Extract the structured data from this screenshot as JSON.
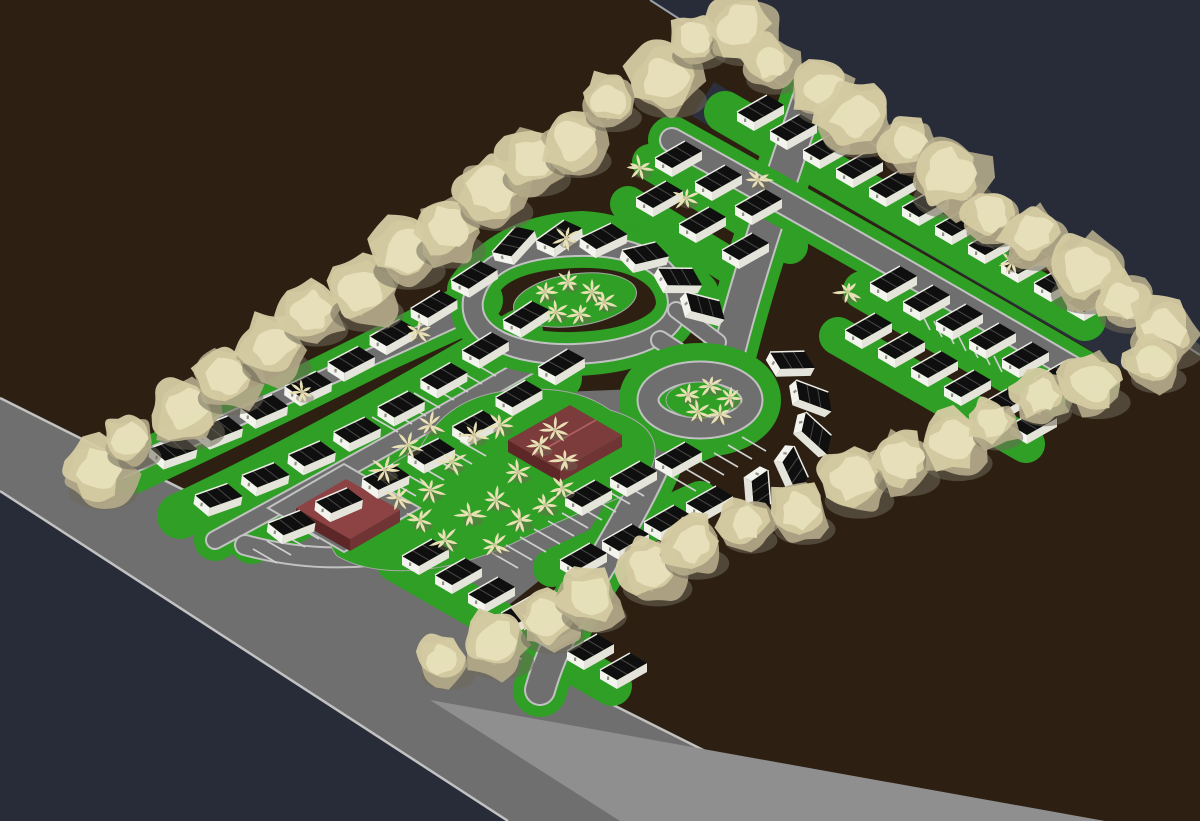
{
  "scene": {
    "title": "isometric-residential-site-plan-render",
    "canvas": {
      "width": 1200,
      "height": 821
    },
    "colors": {
      "background_navy": "#272c38",
      "ground_brown": "#2d2013",
      "edge_hairline": "#9aa0a8",
      "road_gray": "#6f6f6f",
      "road_shoulder": "#8f8f8f",
      "curb_light": "#c2c2c2",
      "stripe_white": "#d0d0d0",
      "lawn_green": "#2f9f25",
      "house_wall": "#f4f4ee",
      "house_wall_shade": "#e4e4da",
      "roof_black": "#0f0f0f",
      "roof_seam": "#474747",
      "roof_ridge": "#ededE6",
      "door_dot": "#8f8f86",
      "tree_light": "#e7e0ba",
      "tree_mid": "#d5cba2",
      "tree_dark": "#b5ab8b",
      "tree_shadow": "#6e6857",
      "tree_trunk": "#d8d0ac",
      "palm_cream": "#e9e1b5",
      "dark_strip": "#2a2f3b",
      "maroon_top": "#8d4343",
      "maroon_mid": "#703434",
      "maroon_dark": "#5e2727",
      "clubhouse_roof": "#7d3c3c",
      "clubhouse_ridge": "#b06060"
    },
    "ground": {
      "brown_poly": [
        [
          0,
          0
        ],
        [
          650,
          0
        ],
        [
          1200,
          355
        ],
        [
          1200,
          821
        ],
        [
          845,
          821
        ],
        [
          0,
          398
        ]
      ],
      "edge_line": [
        [
          650,
          0
        ],
        [
          1200,
          355
        ]
      ],
      "navy_corner": [
        [
          0,
          491
        ],
        [
          260,
          821
        ],
        [
          0,
          821
        ]
      ],
      "main_road_poly": [
        [
          0,
          398
        ],
        [
          845,
          821
        ],
        [
          508,
          821
        ],
        [
          0,
          491
        ]
      ],
      "main_road_curb_top": [
        [
          0,
          398
        ],
        [
          845,
          821
        ]
      ],
      "main_road_curb_bottom": [
        [
          0,
          491
        ],
        [
          508,
          821
        ]
      ],
      "shoulder_poly": [
        [
          430,
          700
        ],
        [
          1105,
          821
        ],
        [
          620,
          821
        ]
      ],
      "pavement_poly": [
        [
          225,
          535
        ],
        [
          420,
          418
        ],
        [
          560,
          392
        ],
        [
          665,
          388
        ],
        [
          706,
          420
        ],
        [
          668,
          476
        ],
        [
          570,
          556
        ],
        [
          470,
          636
        ],
        [
          360,
          658
        ],
        [
          248,
          592
        ]
      ],
      "dark_strip_poly": [
        [
          714,
          82
        ],
        [
          1172,
          346
        ],
        [
          1138,
          378
        ],
        [
          692,
          116
        ]
      ]
    },
    "streets": [
      {
        "id": "street-a",
        "d": "M120,470 Q300,390 470,312",
        "w": 15,
        "verge": true
      },
      {
        "id": "street-b",
        "d": "M215,540 Q400,440 545,356",
        "w": 16,
        "verge": true
      },
      {
        "id": "entry-street",
        "d": "M245,545 C330,568 420,558 480,522 C540,492 590,468 636,468",
        "w": 18,
        "verge": false
      },
      {
        "id": "oval-loop",
        "d": "M473,300 C480,262 520,248 575,246 C640,244 676,268 678,302 C678,336 630,352 575,354 C515,356 468,336 473,300 Z",
        "w": 18,
        "verge": true
      },
      {
        "id": "collector-top",
        "d": "M808,100 C782,178 752,262 730,348",
        "w": 30,
        "verge": true
      },
      {
        "id": "collector-bottom",
        "d": "M670,426 C648,490 610,548 568,620 C555,648 546,668 540,690",
        "w": 28,
        "verge": true
      },
      {
        "id": "top-street",
        "d": "M672,140 C820,222 960,302 1096,382",
        "w": 22,
        "verge": true
      },
      {
        "id": "oval-culdesac-link",
        "d": "M660,340 C690,360 710,372 724,384",
        "w": 16,
        "verge": false
      },
      {
        "id": "oval-collector-link",
        "d": "M676,310 L718,342",
        "w": 14,
        "verge": false
      }
    ],
    "culdesac": {
      "cx": 700,
      "cy": 400,
      "ring_rx": 52,
      "ring_ry": 28,
      "island_rx": 34,
      "island_ry": 18
    },
    "oval_median": {
      "cx": 575,
      "cy": 300,
      "rx": 62,
      "ry": 26,
      "rot": -8
    },
    "row_lawns": [
      {
        "d": "M130,472 Q300,392 480,300",
        "w": 46
      },
      {
        "d": "M180,516 Q330,446 520,332",
        "w": 46
      },
      {
        "d": "M252,542 Q400,470 560,378",
        "w": 44
      },
      {
        "d": "M470,290 C500,248 540,236 582,234 C625,236 662,258 696,294",
        "w": 46
      },
      {
        "d": "M725,112 L1085,320",
        "w": 42
      },
      {
        "d": "M650,162 L790,246",
        "w": 36
      },
      {
        "d": "M628,204 L740,272",
        "w": 36
      },
      {
        "d": "M862,290 L1050,398",
        "w": 38
      },
      {
        "d": "M838,336 L1026,444",
        "w": 38
      },
      {
        "d": "M396,562 L612,686",
        "w": 40
      },
      {
        "d": "M552,568 L700,500",
        "w": 38
      },
      {
        "d": "M558,504 L712,438",
        "w": 36
      }
    ],
    "house_rows": [
      {
        "id": "nw-row-1",
        "start": [
          150,
          448
        ],
        "step": [
          43,
          -24
        ],
        "n": 8,
        "bow": 12,
        "rot0": 10,
        "rot1": -4
      },
      {
        "id": "nw-row-2",
        "start": [
          195,
          495
        ],
        "step": [
          44,
          -25
        ],
        "n": 8,
        "bow": 14,
        "rot0": 10,
        "rot1": -4
      },
      {
        "id": "nw-row-3",
        "start": [
          268,
          523
        ],
        "step": [
          45,
          -26
        ],
        "n": 7,
        "bow": 10,
        "rot0": 8,
        "rot1": -2
      },
      {
        "id": "top-row-1",
        "start": [
          737,
          112
        ],
        "step": [
          33,
          19
        ],
        "n": 11,
        "bow": 0,
        "rot0": 0,
        "rot1": 0
      },
      {
        "id": "top-row-2",
        "start": [
          655,
          158
        ],
        "step": [
          40,
          24
        ],
        "n": 3,
        "bow": 0,
        "rot0": 0,
        "rot1": 0
      },
      {
        "id": "top-row-3",
        "start": [
          636,
          198
        ],
        "step": [
          43,
          26
        ],
        "n": 3,
        "bow": 0,
        "rot0": 0,
        "rot1": 0
      },
      {
        "id": "right-mid-1",
        "start": [
          870,
          283
        ],
        "step": [
          33,
          19
        ],
        "n": 6,
        "bow": 0,
        "rot0": 0,
        "rot1": 0
      },
      {
        "id": "right-mid-2",
        "start": [
          845,
          330
        ],
        "step": [
          33,
          19
        ],
        "n": 6,
        "bow": 0,
        "rot0": 0,
        "rot1": 0
      },
      {
        "id": "bottom-row",
        "start": [
          402,
          556
        ],
        "step": [
          33,
          19
        ],
        "n": 7,
        "bow": 0,
        "rot0": 0,
        "rot1": 0
      },
      {
        "id": "bottom-row-2",
        "start": [
          560,
          560
        ],
        "step": [
          42,
          -19
        ],
        "n": 4,
        "bow": 0,
        "rot0": 0,
        "rot1": 0
      },
      {
        "id": "mid-right-row",
        "start": [
          565,
          497
        ],
        "step": [
          45,
          -19
        ],
        "n": 3,
        "bow": 0,
        "rot0": 0,
        "rot1": 0
      }
    ],
    "arc_houses": [
      [
        492,
        252,
        -18
      ],
      [
        536,
        240,
        -6
      ],
      [
        580,
        238,
        4
      ],
      [
        622,
        250,
        16
      ],
      [
        658,
        268,
        30
      ],
      [
        686,
        292,
        44
      ],
      [
        770,
        352,
        28
      ],
      [
        796,
        380,
        50
      ],
      [
        806,
        412,
        72
      ],
      [
        794,
        446,
        95
      ],
      [
        768,
        470,
        115
      ]
    ],
    "tree_lines": [
      {
        "id": "nw-tree-line",
        "a": [
          92,
          466
        ],
        "b": [
          700,
          46
        ],
        "n": 15,
        "r": 33
      },
      {
        "id": "ne-tree-line",
        "a": [
          732,
          30
        ],
        "b": [
          1166,
          332
        ],
        "n": 11,
        "r": 36
      },
      {
        "id": "se-tree-line",
        "a": [
          442,
          658
        ],
        "b": [
          1148,
          358
        ],
        "n": 15,
        "r": 32
      }
    ],
    "palms_island": [
      [
        385,
        470
      ],
      [
        408,
        445
      ],
      [
        430,
        490
      ],
      [
        452,
        462
      ],
      [
        474,
        435
      ],
      [
        496,
        500
      ],
      [
        518,
        472
      ],
      [
        540,
        445
      ],
      [
        562,
        488
      ],
      [
        420,
        520
      ],
      [
        445,
        540
      ],
      [
        470,
        515
      ],
      [
        495,
        545
      ],
      [
        520,
        520
      ],
      [
        398,
        498
      ],
      [
        545,
        505
      ],
      [
        565,
        460
      ],
      [
        430,
        425
      ],
      [
        500,
        425
      ],
      [
        555,
        430
      ]
    ],
    "palms_median": [
      [
        545,
        292
      ],
      [
        568,
        282
      ],
      [
        592,
        292
      ],
      [
        556,
        312
      ],
      [
        580,
        314
      ],
      [
        604,
        302
      ]
    ],
    "palms_culdesac": [
      [
        688,
        395
      ],
      [
        710,
        386
      ],
      [
        730,
        398
      ],
      [
        698,
        412
      ],
      [
        720,
        414
      ]
    ],
    "palms_scatter": [
      [
        640,
        168
      ],
      [
        686,
        198
      ],
      [
        566,
        238
      ],
      [
        848,
        292
      ],
      [
        758,
        180
      ],
      [
        553,
        600
      ],
      [
        530,
        622
      ],
      [
        302,
        392
      ],
      [
        418,
        332
      ],
      [
        1012,
        262
      ]
    ],
    "parking_stripes": [
      {
        "start": [
          348,
          505
        ],
        "step": [
          14,
          -8
        ],
        "n": 9,
        "vec": [
          26,
          15
        ]
      },
      {
        "start": [
          492,
          553
        ],
        "step": [
          14,
          -8
        ],
        "n": 10,
        "vec": [
          26,
          15
        ]
      },
      {
        "start": [
          372,
          417
        ],
        "step": [
          14,
          -8
        ],
        "n": 8,
        "vec": [
          26,
          15
        ]
      },
      {
        "start": [
          672,
          477
        ],
        "step": [
          14,
          -8
        ],
        "n": 6,
        "vec": [
          24,
          14
        ]
      },
      {
        "start": [
          930,
          330
        ],
        "step": [
          12,
          7
        ],
        "n": 7,
        "vec": [
          -8,
          -16
        ]
      },
      {
        "start": [
          253,
          549
        ],
        "step": [
          14,
          -8
        ],
        "n": 6,
        "vec": [
          24,
          14
        ]
      }
    ],
    "flat_building": {
      "pad": [
        [
          268,
          508
        ],
        [
          344,
          464
        ],
        [
          420,
          508
        ],
        [
          344,
          552
        ]
      ],
      "top": [
        [
          296,
          508
        ],
        [
          346,
          479
        ],
        [
          400,
          510
        ],
        [
          350,
          539
        ]
      ],
      "wall_sw": [
        [
          296,
          508
        ],
        [
          350,
          539
        ],
        [
          350,
          551
        ],
        [
          296,
          520
        ]
      ],
      "wall_se": [
        [
          350,
          539
        ],
        [
          400,
          510
        ],
        [
          400,
          522
        ],
        [
          350,
          551
        ]
      ]
    },
    "clubhouse": {
      "r0": [
        508,
        440
      ],
      "v": [
        62,
        -35
      ],
      "u": [
        52,
        30
      ],
      "wall_h": 12
    },
    "counts": {
      "houses_total": 77,
      "big_trees": 41,
      "palms": 41
    }
  }
}
